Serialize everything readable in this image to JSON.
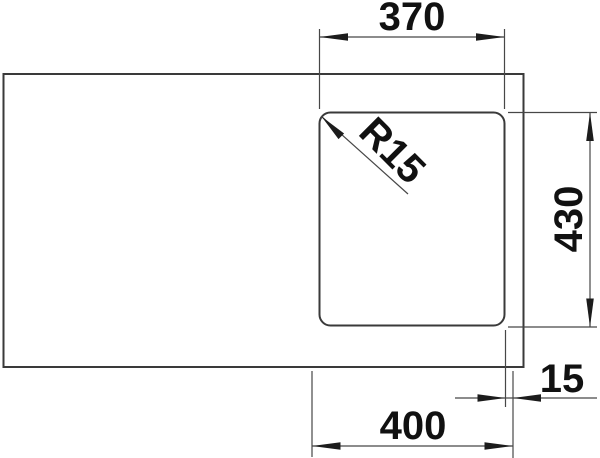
{
  "drawing": {
    "title": "sink-bowl-dimension-drawing",
    "dimensions": {
      "bowl_width": "370",
      "bowl_height": "430",
      "corner_radius": "R15",
      "edge_offset": "15",
      "cutout_width": "400"
    },
    "colors": {
      "background": "#ffffff",
      "outline": "#3a3a3a",
      "dimension_lines": "#474747",
      "text": "#111111"
    }
  }
}
